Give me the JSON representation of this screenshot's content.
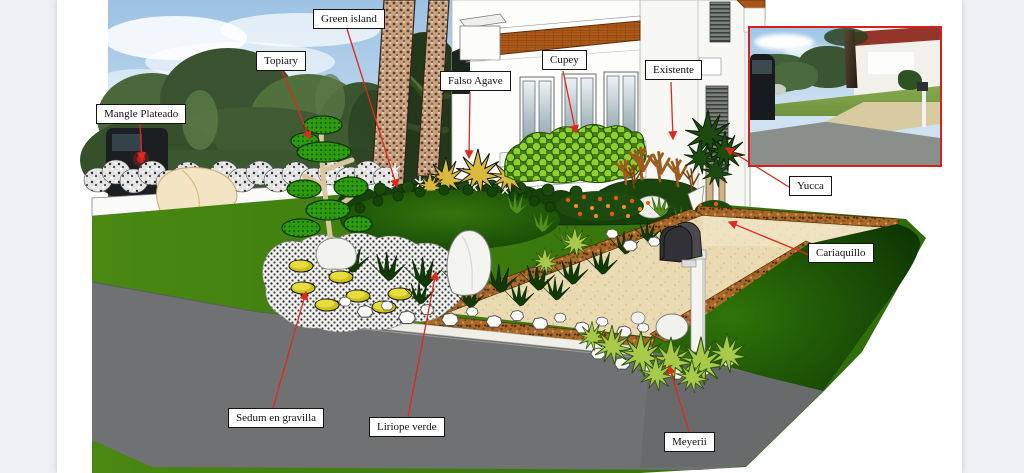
{
  "app": {
    "background": "#eef0f3",
    "canvas_background": "#ffffff"
  },
  "labels": {
    "mangle_plateado": "Mangle Plateado",
    "topiary": "Topiary",
    "green_island": "Green island",
    "falso_agave": "Falso Agave",
    "cupey": "Cupey",
    "existente": "Existente",
    "yucca": "Yucca",
    "cariaquillo": "Cariaquillo",
    "sedum_en_gravilla": "Sedum en gravilla",
    "liriope_verde": "Liriope verde",
    "meyerii": "Meyerii"
  },
  "callout_style": {
    "leader_color": "#e0281c",
    "box_border": "#141414",
    "box_background": "#ffffff",
    "text_color": "#111111"
  },
  "inset_photo": {
    "border_color": "#d81f1f"
  },
  "palette": {
    "lawn": "#47830f",
    "lawn_dark": "#0c3803",
    "island": "#134606",
    "road": "#6f7173",
    "driveway": "#e9dab2",
    "mulch": "#a8682a",
    "roof_tile": "#ad5a18",
    "sky": "#9dc2e4",
    "sedum_stone": "#cfc117"
  }
}
